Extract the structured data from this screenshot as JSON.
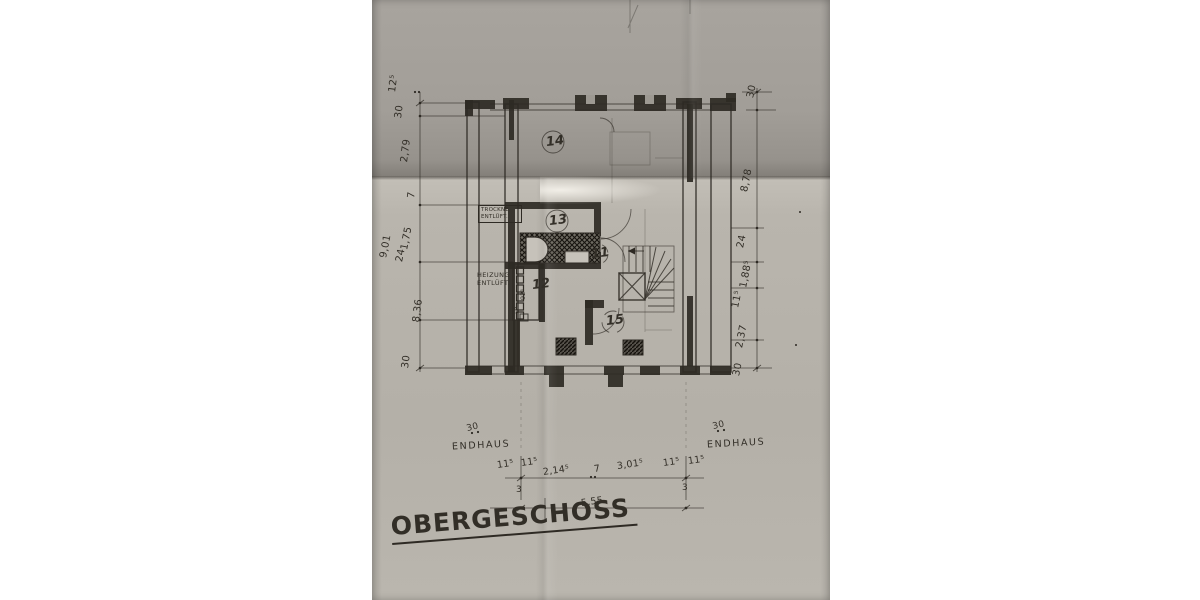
{
  "title": "OBERGESCHOSS",
  "rooms": {
    "r14": "14",
    "r13": "13",
    "r11": "11",
    "r12": "12",
    "r15": "15"
  },
  "labels": {
    "trockner_line1": "TROCKNE",
    "trockner_line2": "ENTLÜFT.",
    "heizung_line1": "HEIZUNG",
    "heizung_line2": "ENTLÜFT.",
    "endhaus_left": "ENDHAUS",
    "endhaus_right": "ENDHAUS",
    "shaft_width": "92⁵",
    "shaft_step": "5"
  },
  "dims": {
    "left": [
      "12⁵",
      "30",
      "2,79",
      "7",
      "1,75",
      "24",
      "9,01",
      "8,36",
      "30"
    ],
    "right": [
      "30",
      "8,78",
      "24",
      "1,88⁵",
      "11⁵",
      "2,37",
      "30"
    ],
    "bottom": [
      "11⁵",
      "11⁵",
      "2,14⁵",
      "7",
      "3,01⁵",
      "11⁵",
      "11⁵"
    ],
    "bottom_sub": [
      "3",
      "3"
    ],
    "bottom_total": "5,55",
    "endhaus_left_offset": "30",
    "endhaus_right_offset": "30"
  },
  "colors": {
    "background": "#ffffff",
    "paper": "#b4b0a8",
    "paper_shadow": "#837f79",
    "ink": "#2e2a24"
  }
}
